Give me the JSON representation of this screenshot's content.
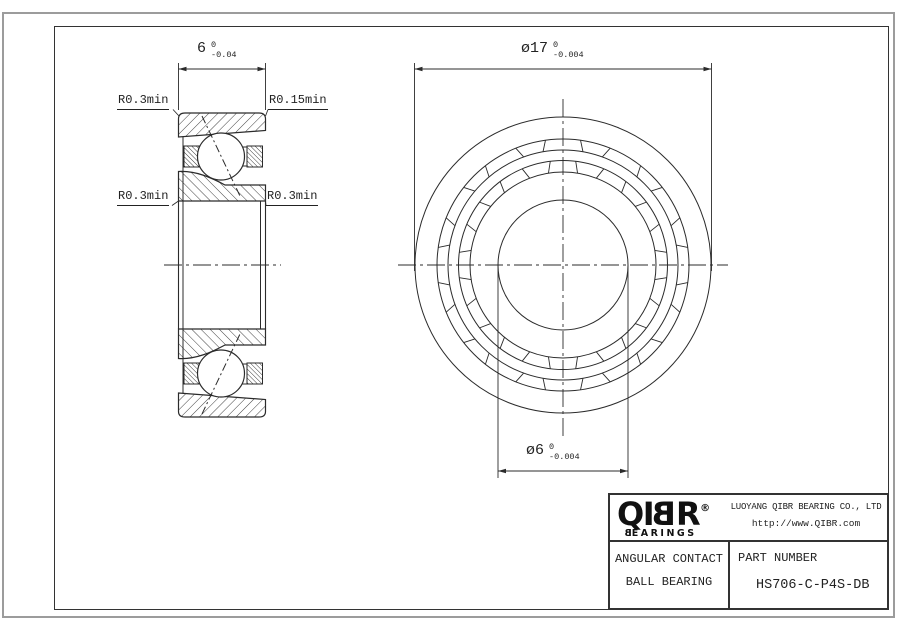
{
  "drawing": {
    "left_view": {
      "width_dim": {
        "nominal": "6",
        "upper": "0",
        "lower": "-0.04"
      },
      "fillet_top_left": "R0.3min",
      "fillet_top_right": "R0.15min",
      "fillet_mid_left": "R0.3min",
      "fillet_mid_right": "R0.3min"
    },
    "front_view": {
      "outer_dia_dim": {
        "prefix": "ø",
        "nominal": "17",
        "upper": "0",
        "lower": "-0.004"
      },
      "bore_dia_dim": {
        "prefix": "ø",
        "nominal": "6",
        "upper": "0",
        "lower": "-0.004"
      }
    }
  },
  "title_block": {
    "logo": {
      "l1": "Q",
      "l2": "I",
      "l3": "B",
      "l4": "R",
      "registered": "®",
      "sub_first": "B",
      "sub_rest": "EARINGS"
    },
    "company_name": "LUOYANG QIBR BEARING CO., LTD",
    "website": "http://www.QIBR.com",
    "product_type_line1": "ANGULAR CONTACT",
    "product_type_line2": "BALL BEARING",
    "part_number_label": "PART NUMBER",
    "part_number": "HS706-C-P4S-DB"
  },
  "colors": {
    "line": "#2b2b2b",
    "frame": "#333333",
    "outer_border": "#9c9c9c",
    "background": "#ffffff"
  }
}
